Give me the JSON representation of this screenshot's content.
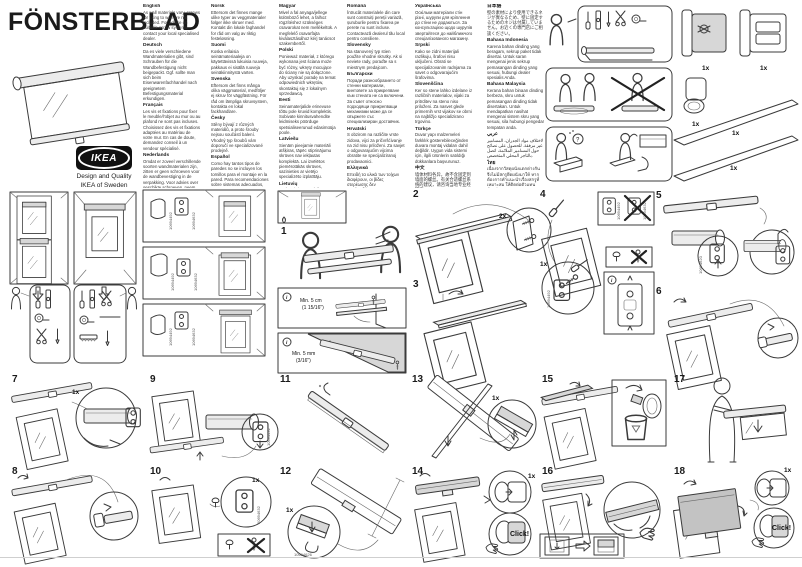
{
  "page": {
    "title": "FÖNSTERBLAD"
  },
  "brand": {
    "logo": "IKEA",
    "tagline1": "Design and Quality",
    "tagline2": "IKEA of Sweden"
  },
  "labels": {
    "qty_1x": "1x",
    "qty_2x": "2x",
    "click": "Click!",
    "min_5cm": "Min. 5 cm",
    "min_5cm_inch": "(1 15/16\")",
    "min_5mm": "Min. 5 mm",
    "min_5mm_inch": "(3/16\")",
    "info": "i"
  },
  "parts": {
    "bracket_left": "10694492",
    "bracket_right": "10694632",
    "spring": "10694620",
    "clip": "10694626"
  },
  "steps": [
    {
      "number": "1"
    },
    {
      "number": "2"
    },
    {
      "number": "3"
    },
    {
      "number": "4"
    },
    {
      "number": "5"
    },
    {
      "number": "6"
    },
    {
      "number": "7"
    },
    {
      "number": "8"
    },
    {
      "number": "9"
    },
    {
      "number": "10"
    },
    {
      "number": "11"
    },
    {
      "number": "12"
    },
    {
      "number": "13"
    },
    {
      "number": "14"
    },
    {
      "number": "15"
    },
    {
      "number": "16"
    },
    {
      "number": "17"
    },
    {
      "number": "18"
    }
  ],
  "language_columns": {
    "col1": [
      {
        "name": "English",
        "text": "As wall materials vary, screws for fixing to wall are not included. For advice on suitable screw systems, contact your local specialised dealer."
      },
      {
        "name": "Deutsch",
        "text": "Da es viele verschiedene Wandmaterialien gibt, sind Schrauben für die Wandbefestigung nicht beigepackt. Ggf. sollte man sich beim Eisenwarenfachhandel nach geeignetem Befestigungsmaterial erkundigen."
      },
      {
        "name": "Français",
        "text": "Les vis et fixations pour fixer le meuble/l'objet au mur ou au plafond ne sont pas incluses. Choisissez des vis et fixations adaptées au matériau de votre mur. En cas de doute, demandez conseil à un vendeur spécialisé."
      },
      {
        "name": "Nederlands",
        "text": "Omdat er zoveel verschillende soorten wandmaterialen zijn, zitten er geen schroeven voor de wandbevestiging in de verpakking. Voor advies over geschikte schroeven, neem contact op met de plaatselijke vakhandel."
      },
      {
        "name": "Dansk",
        "text": "Der findes mange forskellige vægmaterialer, og derfor medfølger der ikke skruer til vægmontering. Hvis du har brug for råd om forskellige skruer og vægplugs, skal du kontakte en anbefalet forhandler."
      },
      {
        "name": "Íslenska",
        "text": "Veggir húsa eru mismunandi og því fylgja ekki skrúfur til að festa hilluna við vegg. Fáið ráðgjöf um hentugar skrúfur hjá byggingavöruverslun/varðandi hentugar skrúfur."
      }
    ],
    "col2": [
      {
        "name": "Norsk",
        "text": "Ettersom det finnes mange ulike typer av veggmaterialer følger ikke skruer med. Kontakt din lokale faghandel for råd om valg av riktig festeløsning."
      },
      {
        "name": "Suomi",
        "text": "Koska erilaisia seinämateriaaleja on käytettävissä lukuisia ruuveja, pakkaus ei sisällä ruuveja seinäkiinnitystä varten."
      },
      {
        "name": "Svenska",
        "text": "Eftersom det finns många olika väggmaterial, medföljer ej skruv för väggfästning. För råd om lämpliga skruvsystem, kontakta en lokal fackhandlare."
      },
      {
        "name": "Česky",
        "text": "Stěny bývají z různých materiálů, a proto šrouby nejsou součástí balení. Vhodný typ šroubů vám doporučí ve specializované prodejně."
      },
      {
        "name": "Español",
        "text": "Como hay tantos tipos de paredes no se incluyen los tornillos para el montaje en la pared. Para recomendaciones sobre sistemas adecuados, ponte en contacto con un especialista."
      },
      {
        "name": "Italiano",
        "text": "Poiché le pareti sono di materiali diversi, le viti per il fissaggio non sono incluse. Per scegliere le viti adatte, rivolgiti a un rivenditore locale."
      }
    ],
    "col3": [
      {
        "name": "Magyar",
        "text": "Mivel a fal anyaga/jellege különböző lehet, a falhoz rögzítéshez szükséges csavarokat nem mellékeltük. A megfelelő csavarfajta kiválasztásához kérj tanácsot szakembertől."
      },
      {
        "name": "Polski",
        "text": "Ponieważ materiał, z którego wykonana jest ściana może być różny, wkręty mocujące do ściany nie są dołączone. Aby uzyskać poradę na temat odpowiednich wkrętów, skontaktuj się z lokalnym sprzedawcą."
      },
      {
        "name": "Eesti",
        "text": "Seinamaterjalide erinevuse tõttu pole kruvid komplektis. Sobivate kinnitusvahendite leidmiseks pöörduge spetsialiseerunud edasimüüja poole."
      },
      {
        "name": "Latviešu",
        "text": "Sienām pieejamie materiāli atšķiras, tāpēc stiprinājumu skrūves nav iekļautas komplektā. Lai izvēlētos piemērotākās skrūves, sazinieties ar vietējo specializēto izplatītāju."
      },
      {
        "name": "Lietuvių",
        "text": "Kadangi sienų apdailos medžiagos būna įvairios, varžtai prie sienos tvirtinti nepridedami. Dėl tinkamų varžtų kreipkitės į vietinius specializuotus pardavėjus."
      },
      {
        "name": "Português",
        "text": "Como os materiais de parede variam, os parafusos para fixação à parede não estão incluídos. Para obter conselhos sobre o sistema de parafusos adequado, consulte o seu revendedor local especializado."
      }
    ],
    "col4": [
      {
        "name": "Românâ",
        "text": "Întrucât materialele din care sunt construiți pereții variază, șuruburile pentru fixarea pe perete nu sunt incluse. Contactează dealerul tău local pentru consiliere."
      },
      {
        "name": "Slovensky",
        "text": "Na stanovený typ stien použite vhodné skrutky. Ak si neviete rady, poraďte sa s miestnym predajcom."
      },
      {
        "name": "Български",
        "text": "Поради разнообразието от стенни материали, винтовете за прикрепване към стената не са включени. За съвет относно подходящи прикрепващи механизми може да се свържете със специализиран доставчик."
      },
      {
        "name": "Hrvatski",
        "text": "S obzirom na različite vrste zidova, vijci za pričvršćivanje na zid nisu priloženi. Za savjet o odgovarajućim vijcima obratite se specijaliziranoj prodavaonici."
      },
      {
        "name": "Ελληνικά",
        "text": "Επειδή τα υλικά των τοίχων διαφέρουν, οι βίδες στερέωσης δεν περιλαμβάνονται. Για πληροφορίες σχετικά με το κατάλληλο είδος βιδών, επικοινωνήστε με ένα ειδικευμένο κατάστημα."
      },
      {
        "name": "Русский",
        "text": "Так как материалы стен различаются, шурупы для фиксации на стене не прилагаются. Для выбора подходящих креплений обратитесь в специализированный магазин."
      }
    ],
    "col5": [
      {
        "name": "Українська",
        "text": "Оскільки матеріали стін різні, шурупи для кріплення до стіни не додаються. За консультацією щодо шурупів звертайтеся до найближчого спеціалізованого магазину."
      },
      {
        "name": "Srpski",
        "text": "Kako se zidni materijali razlikuju, šrafovi nisu uključeni. Obrati se specijalizovanim radnjama za savet o odgovarajućim šrafovima."
      },
      {
        "name": "Slovenščina",
        "text": "Ker so stene lahko izdelane iz različnih materialov, vijaki za pritrditev na steno niso priloženi. Za nasvet glede primernih vrst vijakov se obrni na najbližjo specializirano trgovino."
      },
      {
        "name": "Türkçe",
        "text": "Duvar yapı malzemeleri farklılık gösterebileceğinden duvara montaj vidaları dahil değildir. Uygun vida sistemi için, ilgili ürünlerin satıldığı dükkanlara başvurunuz."
      },
      {
        "name": "中文",
        "text": "墙体材料各异，故不含固定到墙面的螺丝。有关合适螺丝系统的建议，请咨询当地专业经销商。"
      },
      {
        "name": "繁中",
        "text": "因應牆壁材質不同，產品不含固定牆壁用的螺絲。請諮詢住家附近的專門店。"
      },
      {
        "name": "한국어",
        "text": "벽의 소재가 다양하기 때문에 벽 고정용 나사는 포함되어 있지 않습니다. 적합한 나사에 대한 문의는 전문 판매점에 하세요."
      }
    ],
    "col6": [
      {
        "name": "日本語",
        "text": "壁の素材により使用できるネジが異なるため、壁に固定するためのネジは付属していません。お近くの専門店にご相談ください。"
      },
      {
        "name": "Bahasa Indonesia",
        "text": "Karena bahan dinding yang beragam, sekrup paket tidak disertai. Untuk saran mengenai jenis sekrup pemasangan dinding yang sesuai, hubungi dealer spesialis Anda."
      },
      {
        "name": "Bahasa Malaysia",
        "text": "Kerana bahan binaan dinding berbeza, skru untuk pemasangan dinding tidak disertakan. Untuk mendapatkan nasihat mengenai sistem skru yang sesuai, sila hubungi pengedar tempatan anda."
      },
      {
        "name": "عربي",
        "text": "لاختلاف مواد الجدران، المسامير غير مرفقة. للحصول على نصائح حول المسامير الملائمة، اتصل بالتاجر المحلي المتخصص."
      },
      {
        "name": "ไทย",
        "text": "เนื่องจากวัสดุผนังแตกต่างกัน จึงไม่มีสกรูยึดผนังมาให้ หากต้องการคำแนะนำเรื่องสกรูที่เหมาะสม ให้ติดต่อตัวแทนจำหน่าย"
      },
      {
        "name": "Tiếng Việt",
        "text": "Do mỗi loại tường khác nhau, vít bắt tường không được bao gồm. Để được tư vấn về loại vít phù hợp, hãy liên hệ với đại lý chuyên dụng gần nhất."
      }
    ]
  }
}
